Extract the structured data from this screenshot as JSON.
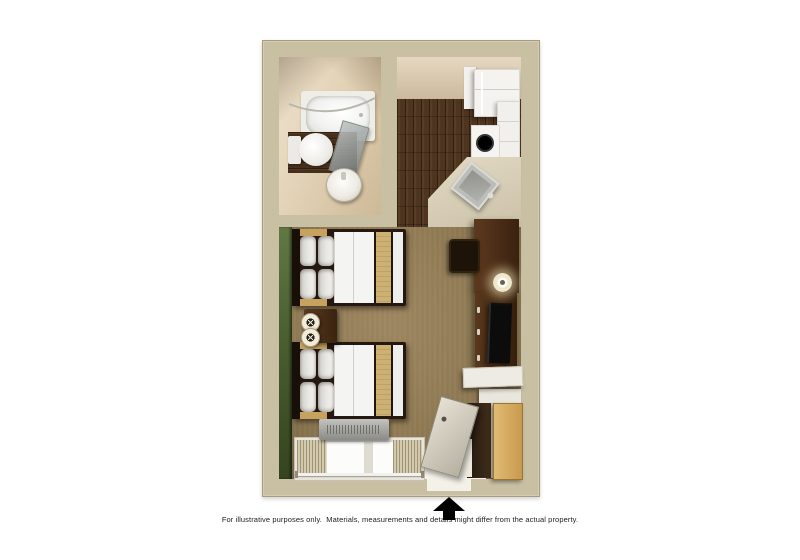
{
  "page": {
    "background": "#ffffff"
  },
  "disclaimer": "For illustrative purposes only.  Materials, measurements and details might differ from the actual property.",
  "entrance": {
    "indicator": "up-arrow",
    "color": "#000000"
  },
  "floor_plan": {
    "type": "studio-suite-top-down-3d-render",
    "rooms": {
      "bathroom": {
        "fixtures": [
          "bathtub",
          "shower-curtain-rod",
          "glass-shower-panel",
          "toilet",
          "pedestal-sink",
          "wood-floor-inset"
        ]
      },
      "kitchen": {
        "fixtures": [
          "refrigerator",
          "upper-cabinet",
          "wall-cabinets",
          "stove-burner",
          "angled-counter",
          "stainless-sink"
        ]
      },
      "main_room": {
        "fixtures": [
          "bed-1",
          "bed-2",
          "nightstand",
          "table-lamp-1",
          "table-lamp-2",
          "desk",
          "desk-chair",
          "desk-lamp",
          "tv-console",
          "tv",
          "wall-shelf",
          "closet-shelf",
          "closet",
          "entry-door",
          "ac-unit",
          "window-with-curtains",
          "green-accent-wall"
        ]
      }
    },
    "colors": {
      "wall": "#c9c0a3",
      "bathroom_wall": "#e2d2b6",
      "wood_floor": "#4e3520",
      "carpet": "#8d7852",
      "accent_wall_green": "#4a5e31",
      "counter": "#d9d0ba",
      "appliance_white": "#f3f2ee",
      "furniture_wood": "#4a2c16",
      "bedding": "#f4f4f2",
      "bed_runner": "#ccb173",
      "closet_door": "#d2a55e",
      "entry_door": "#c9c3b4"
    }
  }
}
